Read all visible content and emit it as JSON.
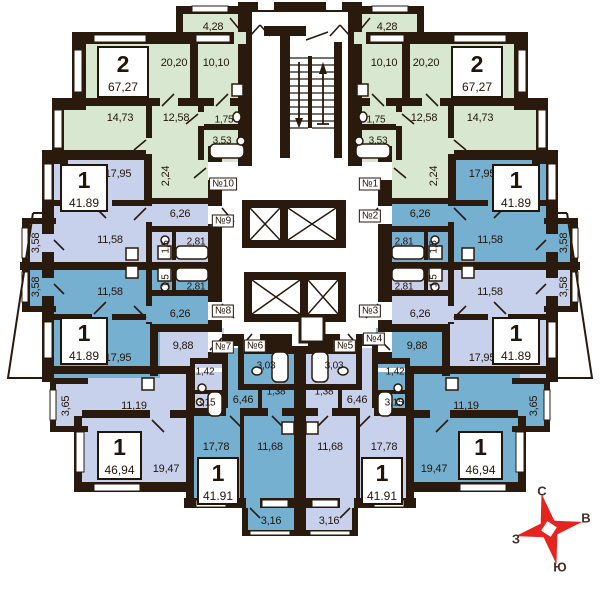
{
  "compass": {
    "north": "С",
    "east": "В",
    "south": "Ю",
    "west": "З"
  },
  "colors": {
    "wall": "#2a1a0d",
    "green": "#d8e8d0",
    "lavender": "#c8d1ec",
    "teal": "#76b0d0",
    "compass_red": "#e5231f"
  },
  "apartments": [
    {
      "id": "two-room-left",
      "unit": "№10",
      "rooms_count": "2",
      "total_area": "67,27",
      "rooms": {
        "living": "20,20",
        "kitchen": "10,10",
        "bedroom": "14,73",
        "hall": "12,58",
        "wc": "1,75",
        "bath": "3,53",
        "balcony": "4,28",
        "vestibule": "2,24"
      }
    },
    {
      "id": "two-room-right",
      "unit": "№1",
      "rooms_count": "2",
      "total_area": "67,27",
      "rooms": {
        "living": "20,20",
        "kitchen": "10,10",
        "bedroom": "14,73",
        "hall": "12,58",
        "wc": "1,75",
        "bath": "3,53",
        "balcony": "4,28",
        "vestibule": "2,24"
      }
    },
    {
      "id": "one-room-mid-upper-left",
      "unit": "№9",
      "rooms_count": "1",
      "total_area": "41.89",
      "rooms": {
        "living": "17,95",
        "kitchen": "11,58",
        "hall": "6,26",
        "bath": "2,81",
        "wc": "1,5",
        "balcony": "3,58"
      }
    },
    {
      "id": "one-room-mid-lower-left",
      "unit": "№8",
      "rooms_count": "1",
      "total_area": "41.89",
      "rooms": {
        "living": "17,95",
        "kitchen": "11,58",
        "hall": "6,26",
        "bath": "2,81",
        "wc": "1,5",
        "balcony": "3,58"
      }
    },
    {
      "id": "one-room-mid-upper-right",
      "unit": "№2",
      "rooms_count": "1",
      "total_area": "41.89",
      "rooms": {
        "living": "17,95",
        "kitchen": "11,58",
        "hall": "6,26",
        "bath": "2,81",
        "wc": "1,5",
        "balcony": "3,58"
      }
    },
    {
      "id": "one-room-mid-lower-right",
      "unit": "№3",
      "rooms_count": "1",
      "total_area": "41.89",
      "rooms": {
        "living": "17,95",
        "kitchen": "11,58",
        "hall": "6,26",
        "bath": "2,81",
        "wc": "1,5",
        "balcony": "3,58"
      }
    },
    {
      "id": "one-room-corner-left",
      "unit": "№7",
      "rooms_count": "1",
      "total_area": "46,94",
      "rooms": {
        "living": "19,47",
        "kitchen": "11,19",
        "hall": "9,88",
        "bath": "3,15",
        "wc": "1,42",
        "balcony": "3,65"
      }
    },
    {
      "id": "one-room-corner-right",
      "unit": "№4",
      "rooms_count": "1",
      "total_area": "46,94",
      "rooms": {
        "living": "19,47",
        "kitchen": "11,19",
        "hall": "9,88",
        "bath": "3,15",
        "wc": "1,42",
        "balcony": "3,65"
      }
    },
    {
      "id": "one-room-center-left",
      "unit": "№6",
      "rooms_count": "1",
      "total_area": "41.91",
      "rooms": {
        "living": "17,78",
        "kitchen": "11,68",
        "hall": "6,46",
        "bath": "3,03",
        "wc": "1,38",
        "balcony": "3,16"
      }
    },
    {
      "id": "one-room-center-right",
      "unit": "№5",
      "rooms_count": "1",
      "total_area": "41.91",
      "rooms": {
        "living": "17,78",
        "kitchen": "11,68",
        "hall": "6,46",
        "bath": "3,03",
        "wc": "1,38",
        "balcony": "3,16"
      }
    }
  ]
}
